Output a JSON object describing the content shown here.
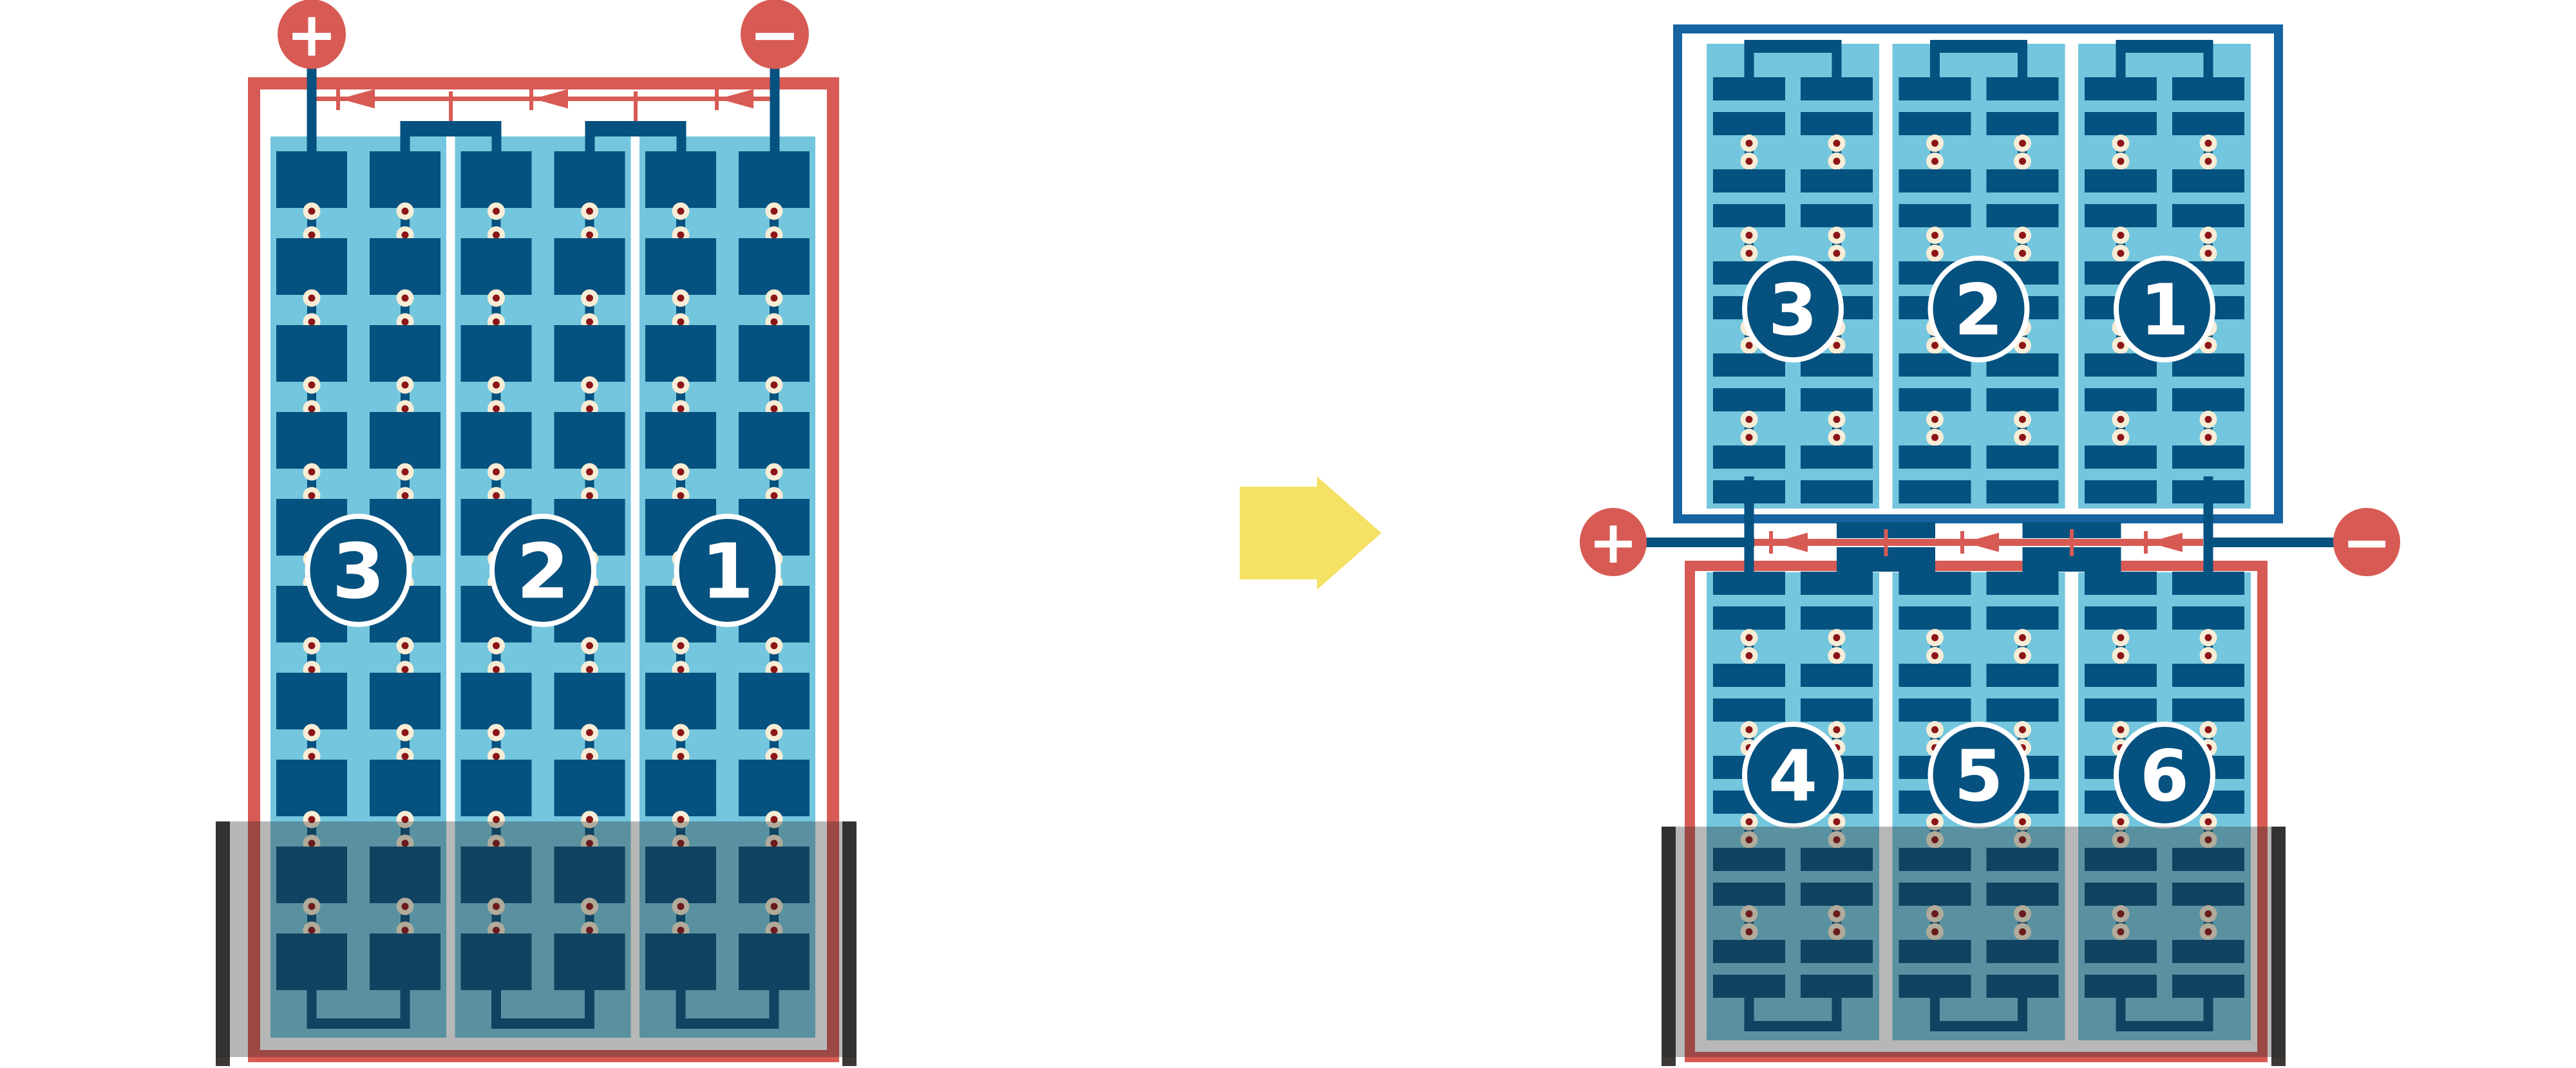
{
  "colors": {
    "background": "#FFFFFF",
    "red": "#D75B54",
    "dark_blue": "#05517F",
    "frame_blue": "#1563A1",
    "light_blue": "#73C6DD",
    "dot_cream": "#F7EDD6",
    "dot_maroon": "#8C1517",
    "arrow_yellow": "#F5E163",
    "shade_bar": "#3B3835",
    "shade_overlay": "rgba(40,40,40,0.335)"
  },
  "left_module": {
    "positive_terminal": "+",
    "negative_terminal": "−",
    "strings": [
      {
        "label": "3"
      },
      {
        "label": "2"
      },
      {
        "label": "1"
      }
    ],
    "cell_rows": 10,
    "columns_per_string": 2,
    "bypass_diode_count": 3,
    "shaded_bottom": true
  },
  "right_module": {
    "positive_terminal": "+",
    "negative_terminal": "−",
    "top_half": {
      "strings": [
        {
          "label": "3"
        },
        {
          "label": "2"
        },
        {
          "label": "1"
        }
      ],
      "row_pairs": 5
    },
    "bottom_half": {
      "strings": [
        {
          "label": "4"
        },
        {
          "label": "5"
        },
        {
          "label": "6"
        }
      ],
      "row_pairs": 5
    },
    "bypass_diode_count": 3,
    "shaded_bottom": true
  }
}
